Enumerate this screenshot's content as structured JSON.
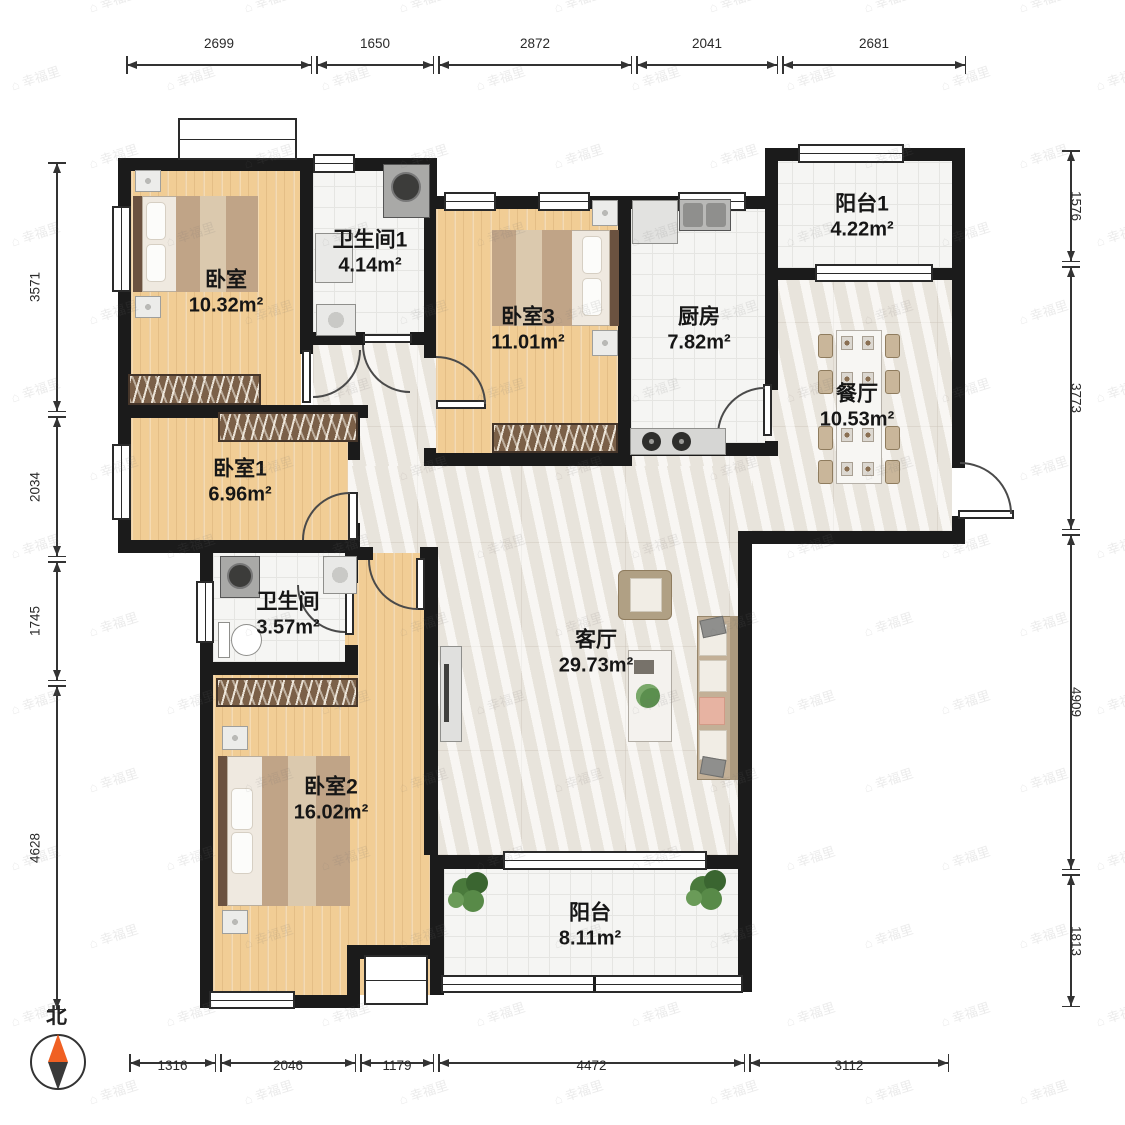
{
  "plan_title": "三室两厅户型图",
  "rooms": [
    {
      "id": "bedroom",
      "name": "卧室",
      "area": "10.32m²"
    },
    {
      "id": "bathroom1",
      "name": "卫生间1",
      "area": "4.14m²"
    },
    {
      "id": "bedroom3",
      "name": "卧室3",
      "area": "11.01m²"
    },
    {
      "id": "kitchen",
      "name": "厨房",
      "area": "7.82m²"
    },
    {
      "id": "balcony1",
      "name": "阳台1",
      "area": "4.22m²"
    },
    {
      "id": "dining",
      "name": "餐厅",
      "area": "10.53m²"
    },
    {
      "id": "bedroom1",
      "name": "卧室1",
      "area": "6.96m²"
    },
    {
      "id": "bathroom",
      "name": "卫生间",
      "area": "3.57m²"
    },
    {
      "id": "living",
      "name": "客厅",
      "area": "29.73m²"
    },
    {
      "id": "bedroom2",
      "name": "卧室2",
      "area": "16.02m²"
    },
    {
      "id": "balcony",
      "name": "阳台",
      "area": "8.11m²"
    }
  ],
  "dimensions": {
    "top": [
      "2699",
      "1650",
      "2872",
      "2041",
      "2681"
    ],
    "bottom": [
      "1316",
      "2046",
      "1179",
      "4472",
      "3112"
    ],
    "left": [
      "3571",
      "2034",
      "1745",
      "4628"
    ],
    "right": [
      "1576",
      "3773",
      "4909",
      "1813"
    ]
  },
  "compass": {
    "label": "北"
  },
  "watermark": {
    "text": "幸福里"
  },
  "colors": {
    "wall": "#1b1b1b",
    "wood_floor": "#f1cd95",
    "tile_floor": "#f5f5f3",
    "marble_floor": "#f0ece5",
    "compass_north": "#f06023",
    "compass_south": "#3a3a3a"
  }
}
